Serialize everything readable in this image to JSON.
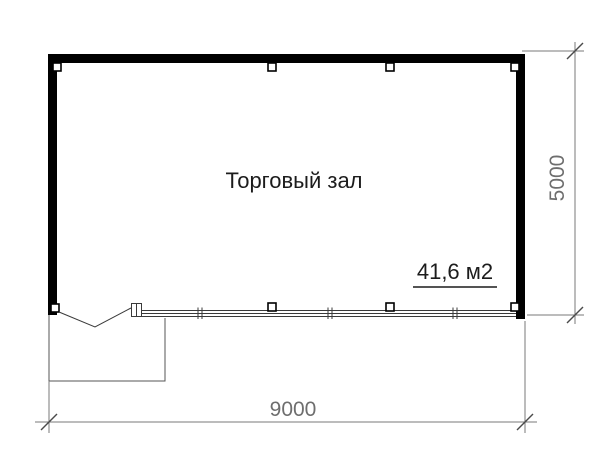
{
  "plan": {
    "room_label": "Торговый зал",
    "area_label": "41,6 м2",
    "width_dimension": "9000",
    "height_dimension": "5000"
  },
  "colors": {
    "wall": "#000000",
    "thin_line": "#3a3a3a",
    "dimension_line": "#787878",
    "dimension_text": "#6e6e6e",
    "label_text": "#1c1c1c",
    "background": "#ffffff"
  }
}
